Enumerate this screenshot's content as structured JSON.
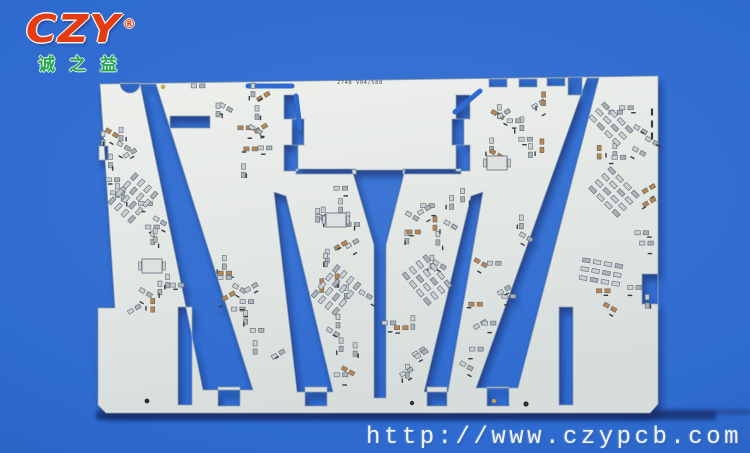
{
  "background": {
    "color": "#2e6bd0"
  },
  "logo": {
    "text": "CZY",
    "registered": "®",
    "subtext": "诚之益",
    "text_color": "#e63b10",
    "subtext_color": "#1fa54b"
  },
  "pcb": {
    "board_label": "2748 V04/588",
    "board_color": "#e7eae6",
    "board_color_dark": "#d7dedc",
    "edge_color": "#8fa0ae",
    "pad_color": "#c9d0d4",
    "pad_color_dark": "#a9b2b9",
    "pad_edge": "#5f6a72",
    "copper_color": "#c08449",
    "silkscreen_color": "#363e45",
    "fiducial_gold": "#c9a44d",
    "hole_dark": "#2b3238"
  },
  "footer": {
    "url": "http://www.czypcb.com",
    "color": "#eef3fa"
  }
}
